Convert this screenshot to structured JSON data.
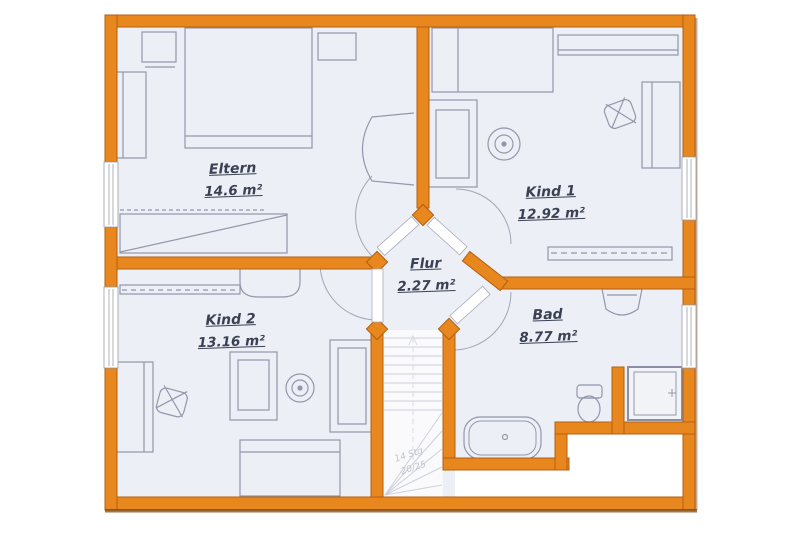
{
  "plan_title": "Obergeschoss Grundriss",
  "rooms": [
    {
      "id": "eltern",
      "name": "Eltern",
      "area": "14.6 m²"
    },
    {
      "id": "kind1",
      "name": "Kind 1",
      "area": "12.92 m²"
    },
    {
      "id": "kind2",
      "name": "Kind 2",
      "area": "13.16 m²"
    },
    {
      "id": "flur",
      "name": "Flur",
      "area": "2.27 m²"
    },
    {
      "id": "bad",
      "name": "Bad",
      "area": "8.77 m²"
    }
  ],
  "stairs": {
    "line1": "14 Stg",
    "line2": "20/25"
  },
  "colors": {
    "wall": "#E8871E",
    "wall_outline": "#B35F10",
    "wall_shadow": "#7C4A10",
    "floor": "#EDEFF6",
    "stair_floor": "#FAFAFC",
    "furniture_line": "#9198AB",
    "door_line": "#A0A6B8",
    "label_text": "#3A4154",
    "background": "#FFFFFF"
  }
}
